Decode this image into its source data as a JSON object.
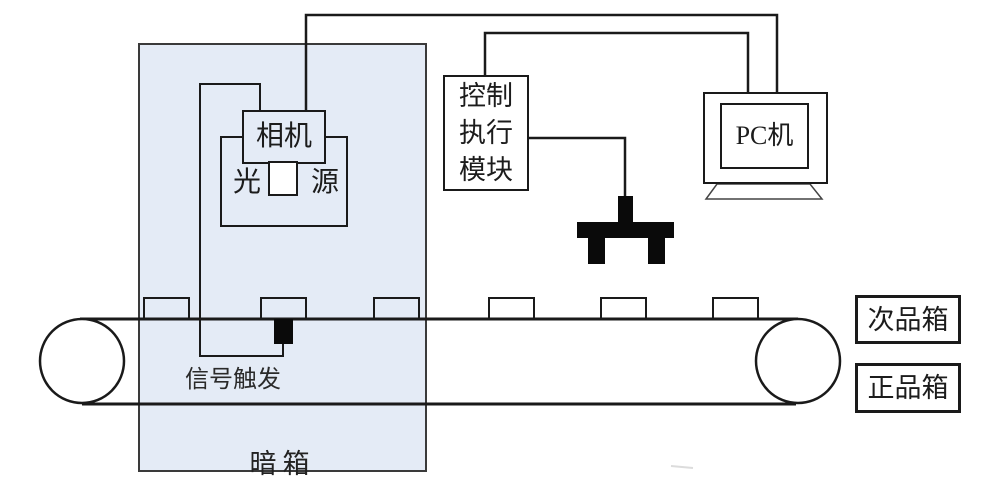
{
  "diagram": {
    "description": "Machine vision inspection and sorting system schematic",
    "dark_box": {
      "label": "暗箱"
    },
    "camera": {
      "label": "相机"
    },
    "light_source": {
      "left_char": "光",
      "right_char": "源"
    },
    "control_module": {
      "line1": "控制",
      "line2": "执行",
      "line3": "模块"
    },
    "pc": {
      "label": "PC机"
    },
    "trigger": {
      "label": "信号触发"
    },
    "bins": {
      "reject": "次品箱",
      "accept": "正品箱"
    },
    "belt": {
      "item_count": 6
    },
    "colors": {
      "dark_box_fill": "#e4ebf6",
      "line": "#1a1a1a",
      "actuator_fill": "#0a0a0a"
    }
  }
}
